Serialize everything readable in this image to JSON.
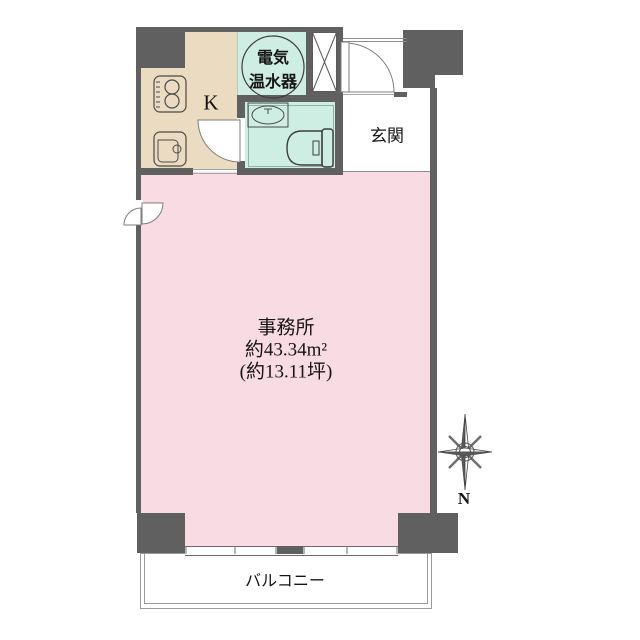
{
  "floor_plan": {
    "rooms": {
      "kitchen": {
        "label": "K",
        "color": "#ebdcc1"
      },
      "water_heater": {
        "line1": "電気",
        "line2": "温水器",
        "color": "#cfeee3"
      },
      "toilet": {
        "color": "#cfeee3"
      },
      "entrance": {
        "label": "玄関",
        "color": "#ffffff"
      },
      "office": {
        "name": "事務所",
        "area_m2": "約43.34m²",
        "area_tsubo": "(約13.11坪)",
        "color": "#f9dbe3"
      },
      "balcony": {
        "label": "バルコニー",
        "color": "#ffffff"
      }
    },
    "compass": {
      "north_label": "N"
    },
    "wall_color": "#606060"
  }
}
